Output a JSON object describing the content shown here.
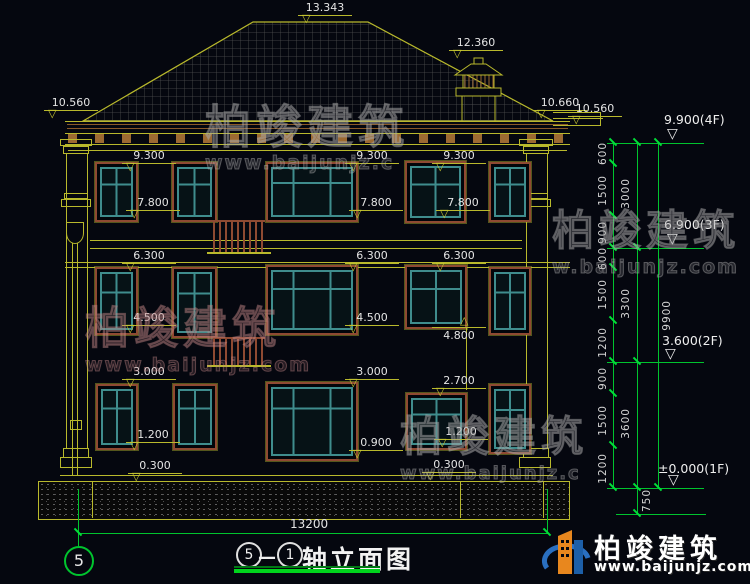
{
  "drawing": {
    "title": {
      "axis_from": "5",
      "separator": "—",
      "axis_to": "1",
      "name": "轴立面图"
    },
    "axis_bubble": "5",
    "bottom_dim": "13200",
    "markers": {
      "m13343": "13.343",
      "m12360": "12.360",
      "m10560L": "10.560",
      "m10660": "10.660",
      "m10560R": "10.560",
      "m9300a": "9.300",
      "m9300b": "9.300",
      "m9300c": "9.300",
      "m7800a": "7.800",
      "m7800b": "7.800",
      "m7800c": "7.800",
      "m6300a": "6.300",
      "m6300b": "6.300",
      "m6300c": "6.300",
      "m4500a": "4.500",
      "m4500b": "4.500",
      "m4800": "4.800",
      "m3000a": "3.000",
      "m3000b": "3.000",
      "m2700": "2.700",
      "m1200a": "1.200",
      "m1200b": "1.200",
      "m0900": "0.900",
      "m0300a": "0.300",
      "m0300b": "0.300"
    },
    "floor_markers": {
      "f4": "9.900(4F)",
      "f3": "6.900(3F)",
      "f2": "3.600(2F)",
      "f1": "±0.000(1F)"
    },
    "right_dims": {
      "segments": [
        "600",
        "1500",
        "900",
        "600",
        "1500",
        "1200",
        "900",
        "1500",
        "1200"
      ],
      "floors": [
        "3000",
        "3300",
        "3600"
      ],
      "below_ground": "750",
      "total": "9900"
    }
  },
  "watermark": {
    "brand": "柏竣建筑",
    "url": "www.baijunjz.com",
    "url_short": "www.baijunjz.c",
    "url_short2": "w.baijunjz.com"
  },
  "logo": {
    "brand": "柏竣建筑",
    "url": "www.baijunjz.com"
  },
  "colors": {
    "background": "#05070f",
    "cad_yellow": "#b9b92c",
    "cad_green": "#00c42e",
    "white": "#e6e6e6",
    "window_frame_brown": "#8f4a32",
    "window_teal": "#3f8d8d",
    "logo_blue": "#1d5fa8",
    "logo_orange": "#e8871e"
  }
}
